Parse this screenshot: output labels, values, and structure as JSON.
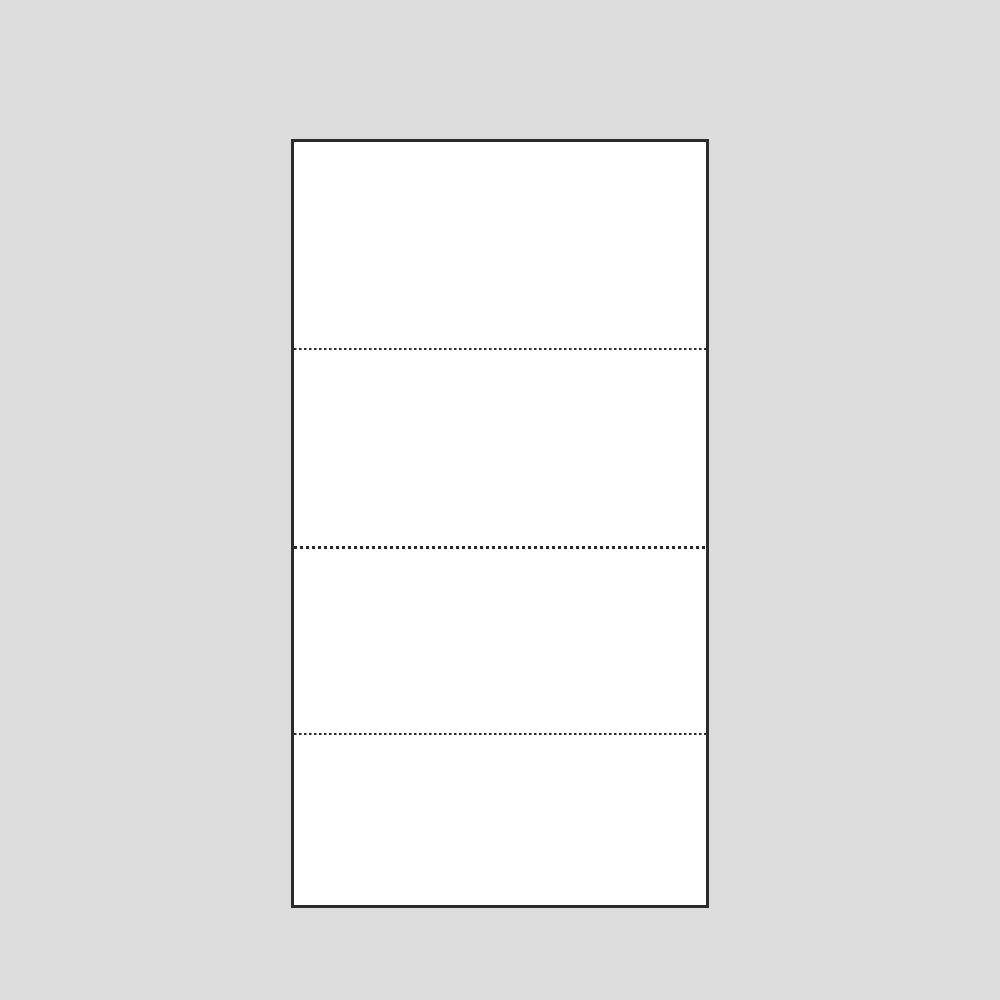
{
  "page": {
    "background_color": "#dcdcdc"
  },
  "sheet": {
    "fill_color": "#ffffff",
    "border_color": "#2b2b2b",
    "border_style": "solid",
    "section_count": 4,
    "divider_color": "#2b2b2b",
    "dividers": [
      {
        "style": "dotted",
        "weight": "regular"
      },
      {
        "style": "dotted",
        "weight": "bold"
      },
      {
        "style": "dotted",
        "weight": "regular"
      }
    ]
  }
}
